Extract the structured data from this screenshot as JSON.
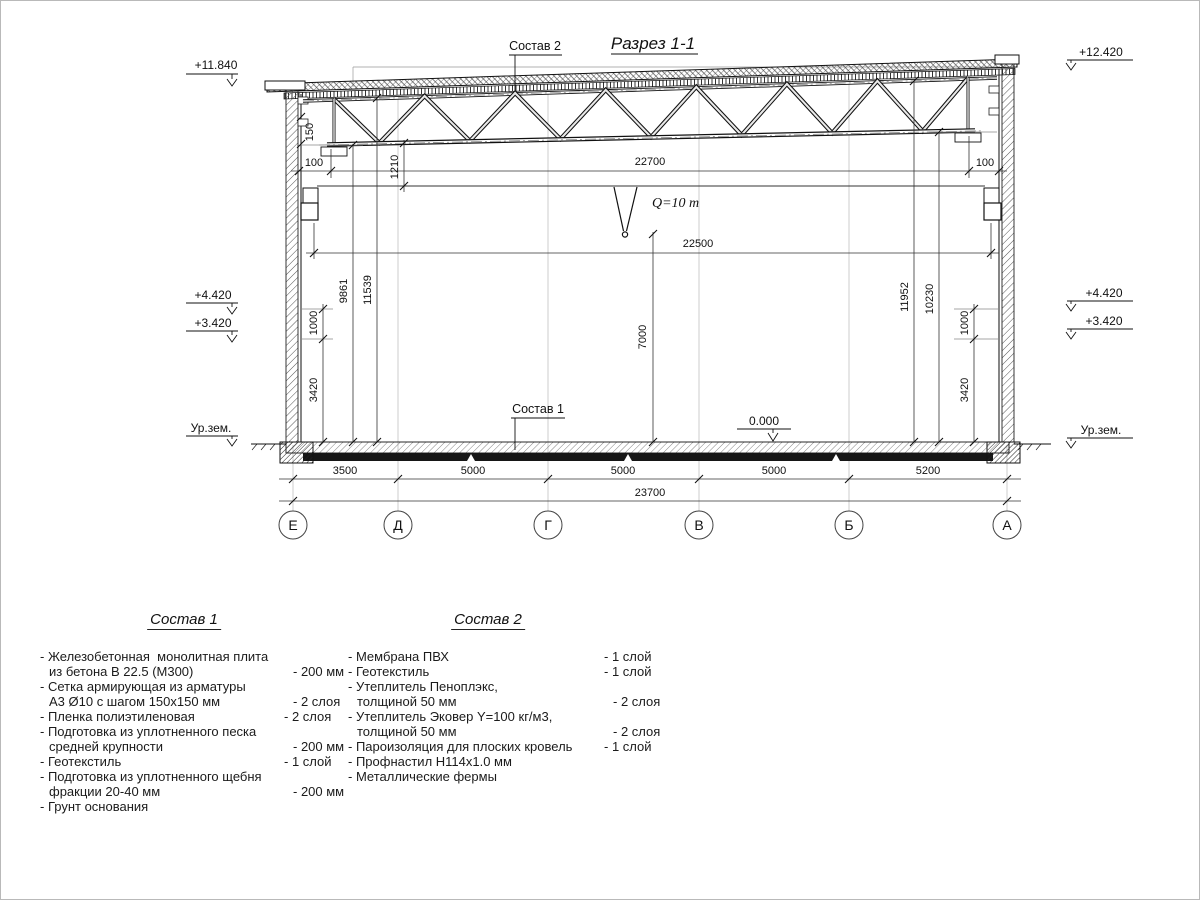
{
  "drawing": {
    "title": "Разрез 1-1",
    "callouts": {
      "roof": "Состав 2",
      "floor": "Состав 1"
    },
    "crane": {
      "capacity": "Q=10 т"
    },
    "elevations": {
      "left_parapet": "+11.840",
      "right_parapet": "+12.420",
      "left_upper": "+4.420",
      "left_lower": "+3.420",
      "left_ground": "Ур.зем.",
      "right_upper": "+4.420",
      "right_lower": "+3.420",
      "right_ground": "Ур.зем.",
      "floor_zero": "0.000"
    },
    "dims": {
      "truss_seat": "150",
      "left_100": "100",
      "right_100": "100",
      "rail_to_truss": "1210",
      "beam_span": "22700",
      "rail_span": "22500",
      "hook_height": "7000",
      "left_to_truss": "9861",
      "left_to_roof": "11539",
      "right_to_roof": "11952",
      "right_to_truss": "10230",
      "left_1000": "1000",
      "left_3420": "3420",
      "right_1000": "1000",
      "right_3420": "3420",
      "spans": [
        "3500",
        "5000",
        "5000",
        "5000",
        "5200"
      ],
      "total": "23700"
    },
    "axes": [
      "Е",
      "Д",
      "Г",
      "В",
      "Б",
      "А"
    ]
  },
  "legend1": {
    "title": "Состав 1",
    "items": [
      {
        "text": [
          "- Железобетонная  монолитная плита",
          "из бетона В 22.5 (М300)"
        ],
        "value": "- 200 мм"
      },
      {
        "text": [
          "- Сетка армирующая из арматуры",
          "А3 Ø10 с шагом 150х150 мм"
        ],
        "value": "- 2 слоя"
      },
      {
        "text": [
          "- Пленка полиэтиленовая"
        ],
        "value": "- 2 слоя"
      },
      {
        "text": [
          "- Подготовка из уплотненного песка",
          "средней крупности"
        ],
        "value": "- 200 мм"
      },
      {
        "text": [
          "- Геотекстиль"
        ],
        "value": "- 1 слой"
      },
      {
        "text": [
          "- Подготовка из уплотненного щебня",
          "фракции 20-40 мм"
        ],
        "value": "- 200 мм"
      },
      {
        "text": [
          "- Грунт основания"
        ],
        "value": ""
      }
    ]
  },
  "legend2": {
    "title": "Состав 2",
    "items": [
      {
        "text": [
          "- Мембрана ПВХ"
        ],
        "value": "- 1 слой"
      },
      {
        "text": [
          "- Геотекстиль"
        ],
        "value": "- 1 слой"
      },
      {
        "text": [
          "- Утеплитель Пеноплэкс,",
          "толщиной 50 мм"
        ],
        "value": "- 2 слоя"
      },
      {
        "text": [
          "- Утеплитель Эковер Y=100 кг/м3,",
          "толщиной 50 мм"
        ],
        "value": "- 2 слоя"
      },
      {
        "text": [
          "- Пароизоляция для плоских кровель"
        ],
        "value": "- 1 слой"
      },
      {
        "text": [
          "- Профнастил Н114х1.0 мм"
        ],
        "value": ""
      },
      {
        "text": [
          "- Металлические фермы"
        ],
        "value": ""
      }
    ]
  }
}
